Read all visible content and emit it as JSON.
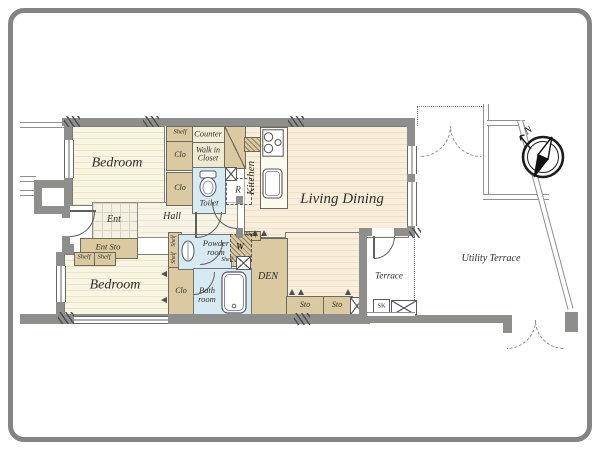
{
  "labels": {
    "bedroom": "Bedroom",
    "living_dining": "Living Dining",
    "kitchen": "Kitchen",
    "counter": "Counter",
    "walk_in_closet": "Walk in Closet",
    "toilet": "Toilet",
    "refrigerator": "R",
    "washer": "W",
    "shelf": "Shelf",
    "clo": "Clo",
    "ent": "Ent",
    "hall": "Hall",
    "ent_sto": "Ent Sto",
    "powder_room": "Powder room",
    "bath_room": "Bath room",
    "den": "DEN",
    "sto": "Sto",
    "terrace": "Terrace",
    "utility_terrace": "Utility Terrace",
    "slop_sink": "SK",
    "north": "N"
  },
  "colors": {
    "floor_cream": "#f8f5e3",
    "floor_peach": "#f9eedb",
    "closet_tan": "#dac9a1",
    "wet_blue": "#d8eaf1",
    "wall_gray": "#8e8e8c",
    "line_gray": "#5f5f5f",
    "text": "#2f2d29"
  }
}
